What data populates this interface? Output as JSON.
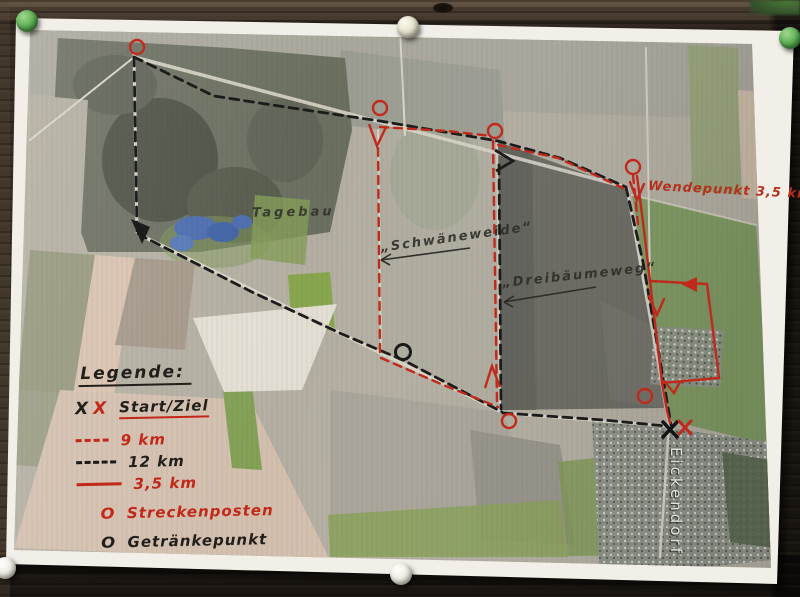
{
  "legend": {
    "title": "Legende:",
    "items": [
      {
        "symbol": "x-x-marks",
        "symbol_black": "X",
        "symbol_red": "X",
        "label": "Start/Ziel"
      },
      {
        "symbol": "red-dashed-line",
        "label": "9 km"
      },
      {
        "symbol": "black-dashed-line",
        "label": "12 km"
      },
      {
        "symbol": "red-solid-line",
        "label": "3,5 km"
      },
      {
        "symbol": "red-circle",
        "symbol_char": "O",
        "label": "Streckenposten"
      },
      {
        "symbol": "black-circle",
        "symbol_char": "O",
        "label": "Getränkepunkt"
      }
    ]
  },
  "map_labels": {
    "tagebau": "Tagebau",
    "schwaeneweide": "„Schwäneweide“",
    "dreibaeumeweg": "„Dreibäumeweg“",
    "wendepunkt": "Wendepunkt 3,5 km",
    "town": "Eickendorf"
  },
  "colors": {
    "route_red": "#c0291c",
    "route_black": "#1a1a1a",
    "legend_red": "#c22718"
  },
  "pins": [
    {
      "position": "top-left",
      "color": "#56a84e"
    },
    {
      "position": "top-center",
      "color": "#dcd9c2"
    },
    {
      "position": "top-right",
      "color": "#56a84e"
    },
    {
      "position": "bottom-center",
      "color": "#e8e6da"
    },
    {
      "position": "bottom-left",
      "color": "#e8e6da"
    }
  ]
}
